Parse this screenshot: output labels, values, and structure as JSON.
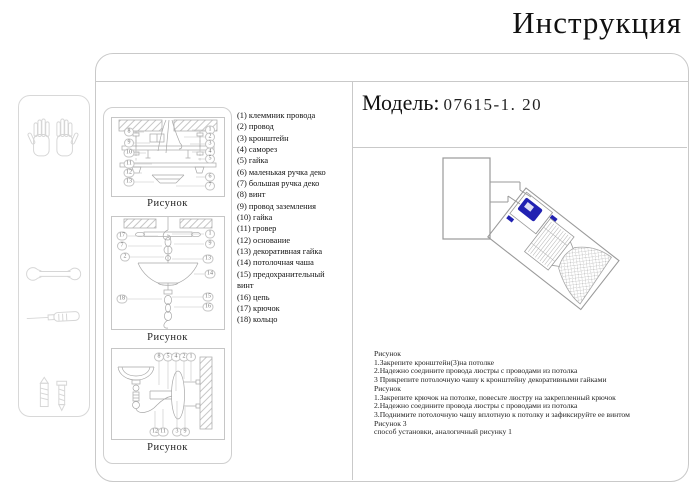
{
  "title": "Инструкция",
  "model": {
    "label": "Модель:",
    "value": "07615-1. 20"
  },
  "parts_list": [
    "(1) клеммник провода",
    "(2) провод",
    "(3) кронштейн",
    "(4) саморез",
    "(5) гайка",
    "(6) маленькая ручка деко",
    "(7) большая ручка деко",
    "(8) винт",
    "(9) провод заземления",
    "(10) гайка",
    "(11) гровер",
    "(12) основание",
    "(13) декоративная гайка",
    "(14) потолочная чаша",
    "(15) предохранительный винт",
    "(16) цепь",
    "(17) крючок",
    "(18) кольцо"
  ],
  "figures": [
    {
      "caption": "Рисунок",
      "callouts": [
        {
          "t": "8",
          "x": 17,
          "y": 14
        },
        {
          "t": "9",
          "x": 17,
          "y": 25
        },
        {
          "t": "10",
          "x": 17,
          "y": 35
        },
        {
          "t": "11",
          "x": 17,
          "y": 46
        },
        {
          "t": "12",
          "x": 17,
          "y": 55
        },
        {
          "t": "13",
          "x": 17,
          "y": 64
        },
        {
          "t": "1",
          "x": 98,
          "y": 12
        },
        {
          "t": "2",
          "x": 98,
          "y": 19
        },
        {
          "t": "3",
          "x": 98,
          "y": 26
        },
        {
          "t": "4",
          "x": 98,
          "y": 34
        },
        {
          "t": "5",
          "x": 98,
          "y": 41
        },
        {
          "t": "6",
          "x": 98,
          "y": 59
        },
        {
          "t": "7",
          "x": 98,
          "y": 68
        }
      ]
    },
    {
      "caption": "Рисунок",
      "callouts": [
        {
          "t": "17",
          "x": 10,
          "y": 19
        },
        {
          "t": "7",
          "x": 10,
          "y": 29
        },
        {
          "t": "2",
          "x": 13,
          "y": 40
        },
        {
          "t": "18",
          "x": 10,
          "y": 82
        },
        {
          "t": "1",
          "x": 98,
          "y": 17
        },
        {
          "t": "9",
          "x": 98,
          "y": 27
        },
        {
          "t": "13",
          "x": 96,
          "y": 42
        },
        {
          "t": "14",
          "x": 98,
          "y": 57
        },
        {
          "t": "15",
          "x": 96,
          "y": 80
        },
        {
          "t": "16",
          "x": 96,
          "y": 90
        }
      ]
    },
    {
      "caption": "Рисунок",
      "callouts": [
        {
          "t": "8",
          "x": 47,
          "y": 8
        },
        {
          "t": "5",
          "x": 56,
          "y": 8
        },
        {
          "t": "4",
          "x": 64,
          "y": 8
        },
        {
          "t": "2",
          "x": 72,
          "y": 8
        },
        {
          "t": "1",
          "x": 79,
          "y": 8
        },
        {
          "t": "12",
          "x": 43,
          "y": 83
        },
        {
          "t": "11",
          "x": 51,
          "y": 83
        },
        {
          "t": "3",
          "x": 65,
          "y": 83
        },
        {
          "t": "9",
          "x": 73,
          "y": 83
        }
      ]
    }
  ],
  "instructions": [
    "Рисунок",
    "1.Закрепите кронштейн(3)на потолке",
    "2.Надежно соедините провода люстры с проводами из потолка",
    "3 Прикрепите потолочную чашу к кронштейну декоративными гайками",
    "Рисунок",
    "1.Закрепите крючок на потолке, повесьте люстру на закрепленный крючок",
    "2.Надежно соедините провода люстры с проводами из потолка",
    "3.Поднимите потолочную чашу вплотную к потолку и зафиксируйте ее винтом",
    "Рисунок 3",
    "способ установки, аналогичный рисунку 1"
  ],
  "tool_icons": [
    "gloves-icon",
    "wrench-icon",
    "screwdriver-icon",
    "dowel-screw-icon",
    "assembly-parts-icon",
    "warning-exclamation-icon"
  ],
  "colors": {
    "accent_blue": "#2121b2",
    "line_gray": "#a8a8a8",
    "faint_gray": "#d6d6d6",
    "rule_gray": "#c9c9c9"
  }
}
